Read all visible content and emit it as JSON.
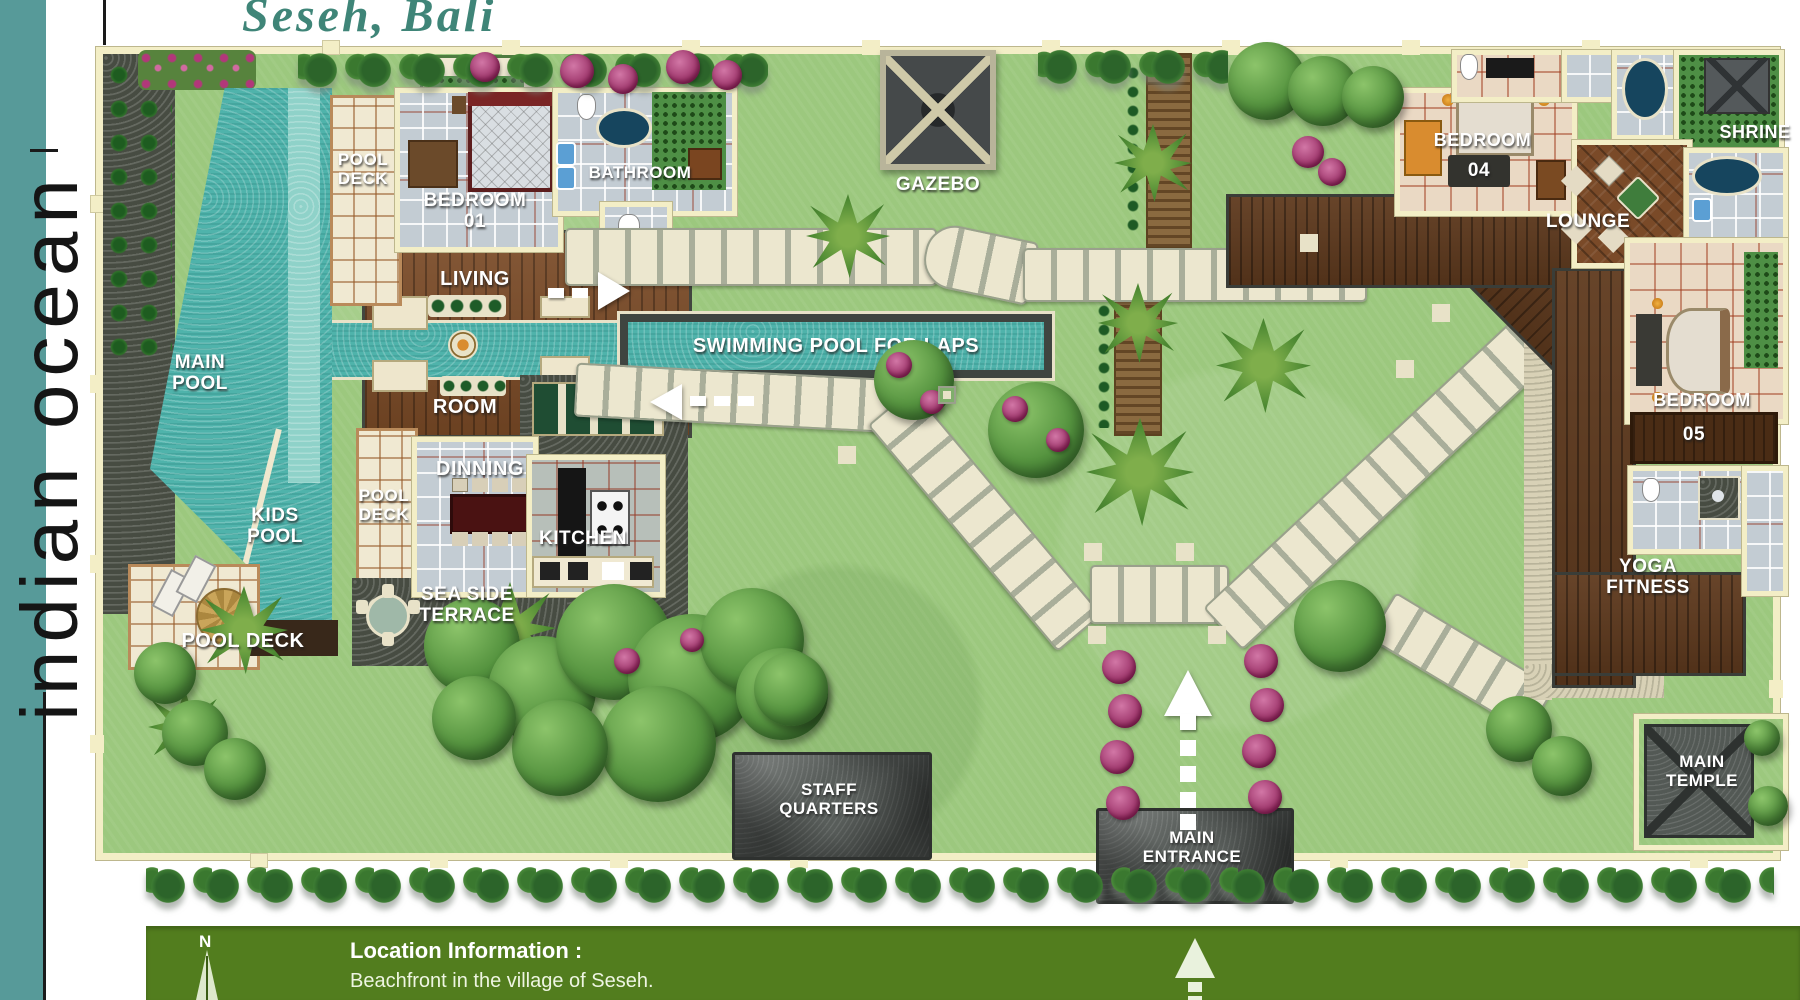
{
  "title": "Seseh, Bali",
  "ocean": "indian ocean",
  "labels": {
    "main_pool": [
      "MAIN",
      "POOL"
    ],
    "kids_pool": [
      "KIDS",
      "POOL"
    ],
    "pool_deck_top": [
      "POOL",
      "DECK"
    ],
    "pool_deck_mid": [
      "POOL",
      "DECK"
    ],
    "pool_deck_bottom": "POOL DECK",
    "bedroom01": [
      "BEDROOM",
      "01"
    ],
    "bathroom": "BATHROOM",
    "living": [
      "LIVING",
      "ROOM"
    ],
    "laps": "SWIMMING POOL FOR LAPS",
    "dinning": "DINNING",
    "kitchen": "KITCHEN",
    "sea_side": [
      "SEA SIDE",
      "TERRACE"
    ],
    "gazebo": "GAZEBO",
    "staff": [
      "STAFF",
      "QUARTERS"
    ],
    "entrance": [
      "MAIN",
      "ENTRANCE"
    ],
    "bedroom04": [
      "BEDROOM",
      "04"
    ],
    "lounge": "LOUNGE",
    "shrine": "SHRINE",
    "bedroom05": [
      "BEDROOM",
      "05"
    ],
    "yoga": [
      "YOGA",
      "FITNESS"
    ],
    "temple": [
      "MAIN",
      "TEMPLE"
    ]
  },
  "info": {
    "compass": "N",
    "heading": "Location Information :",
    "detail": "Beachfront in the village of Seseh."
  },
  "colors": {
    "accent_teal": "#579a99",
    "title_teal": "#3f8578",
    "info_green": "#527d1e",
    "lawn_green": "#9cc87e",
    "pool_teal": "#4fb3ab",
    "wall_cream": "#f3eec6"
  }
}
